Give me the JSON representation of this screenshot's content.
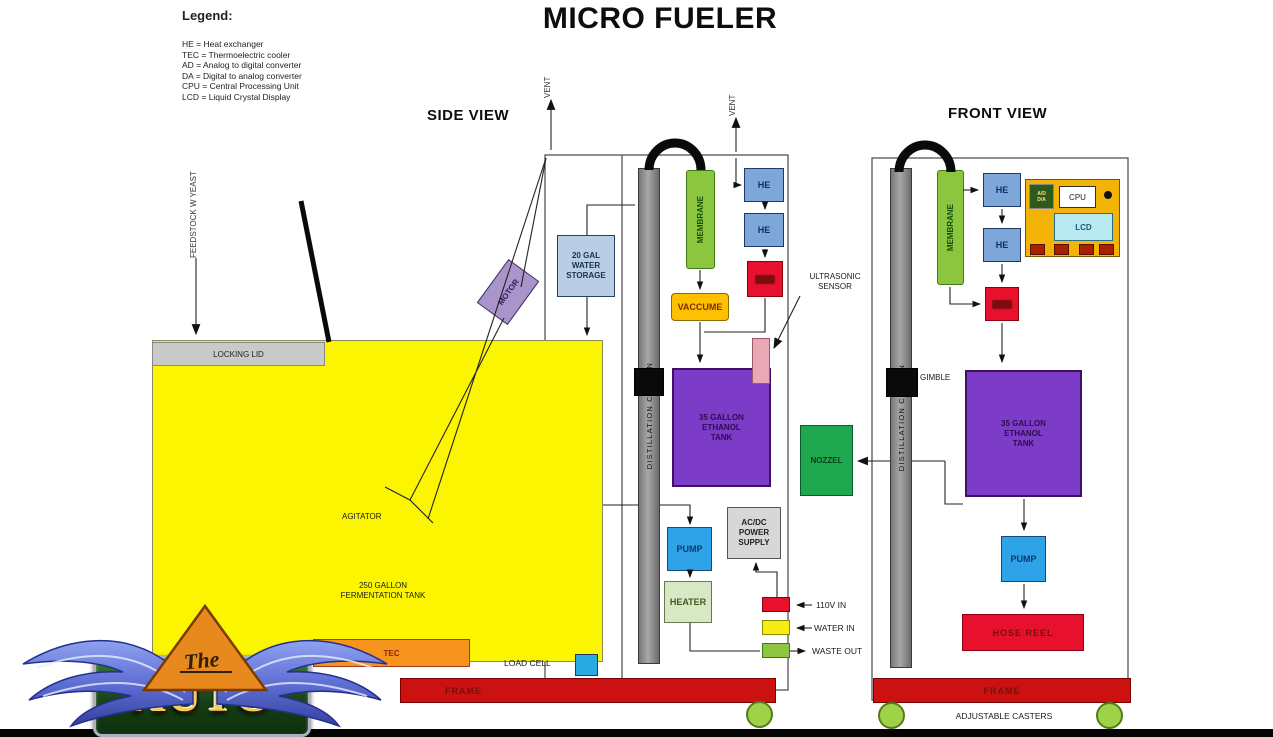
{
  "title": "MICRO FUELER",
  "legend": {
    "heading": "Legend:",
    "entries": [
      "HE = Heat exchanger",
      "TEC = Thermoelectric cooler",
      "AD = Analog to digital converter",
      "DA = Digital to analog converter",
      "CPU = Central Processing Unit",
      "LCD = Liquid Crystal Display"
    ]
  },
  "side_view": {
    "heading": "SIDE VIEW",
    "vent": "VENT",
    "feedstock": "FEEDSTOCK W YEAST",
    "locking_lid": "LOCKING LID",
    "motor": "MOTOR",
    "agitator": "AGITATOR",
    "fermentation_tank": "250 GALLON\nFERMENTATION TANK",
    "tec": "TEC",
    "load_cell": "LOAD CELL",
    "water_storage": "20 GAL\nWATER\nSTORAGE",
    "distillation_column": "DISTILLATION COLUMN",
    "membrane": "MEMBRANE",
    "vaccume": "VACCUME",
    "he": "HE",
    "ultrasonic_sensor": "ULTRASONIC\nSENSOR",
    "ethanol_tank": "35 GALLON\nETHANOL\nTANK",
    "pump": "PUMP",
    "heater": "HEATER",
    "power_supply": "AC/DC\nPOWER\nSUPPLY",
    "frame": "FRAME",
    "io": [
      {
        "label": "110V IN",
        "color": "#e8112d"
      },
      {
        "label": "WATER IN",
        "color": "#f7ec13"
      },
      {
        "label": "WASTE OUT",
        "color": "#8fc641"
      }
    ]
  },
  "front_view": {
    "heading": "FRONT VIEW",
    "distillation_column": "DISTILLATION COLUMN",
    "membrane": "MEMBRANE",
    "he": "HE",
    "gimble": "GIMBLE",
    "nozzel": "NOZZEL",
    "ethanol_tank": "35 GALLON\nETHANOL\nTANK",
    "pump": "PUMP",
    "hose_reel": "HOSE REEL",
    "frame": "FRAME",
    "adjustable_casters": "ADJUSTABLE CASTERS",
    "control_panel": {
      "chip": "A/D\nD/A",
      "cpu": "CPU",
      "lcd": "LCD"
    }
  },
  "logo": {
    "the": "The",
    "auto": "AUTO"
  },
  "colors": {
    "fermentation_tank": "#fbf500",
    "ethanol_tank": "#7d3cc8",
    "membrane": "#8cc63f",
    "column": "#909090",
    "he_box": "#7da7d9",
    "red_box": "#e8112d",
    "pump": "#2ea3e8",
    "heater": "#d9e8c4",
    "vaccume": "#ffc000",
    "water_storage": "#b9cde5",
    "nozzel": "#1fa84f",
    "tec": "#f7941d",
    "frame": "#cc1111",
    "caster": "#9ed348",
    "panel": "#f2b407",
    "lcd": "#b8e8f0",
    "motor": "#a995c9",
    "sensor": "#e8a9b4",
    "power_supply": "#d7d7d7"
  }
}
